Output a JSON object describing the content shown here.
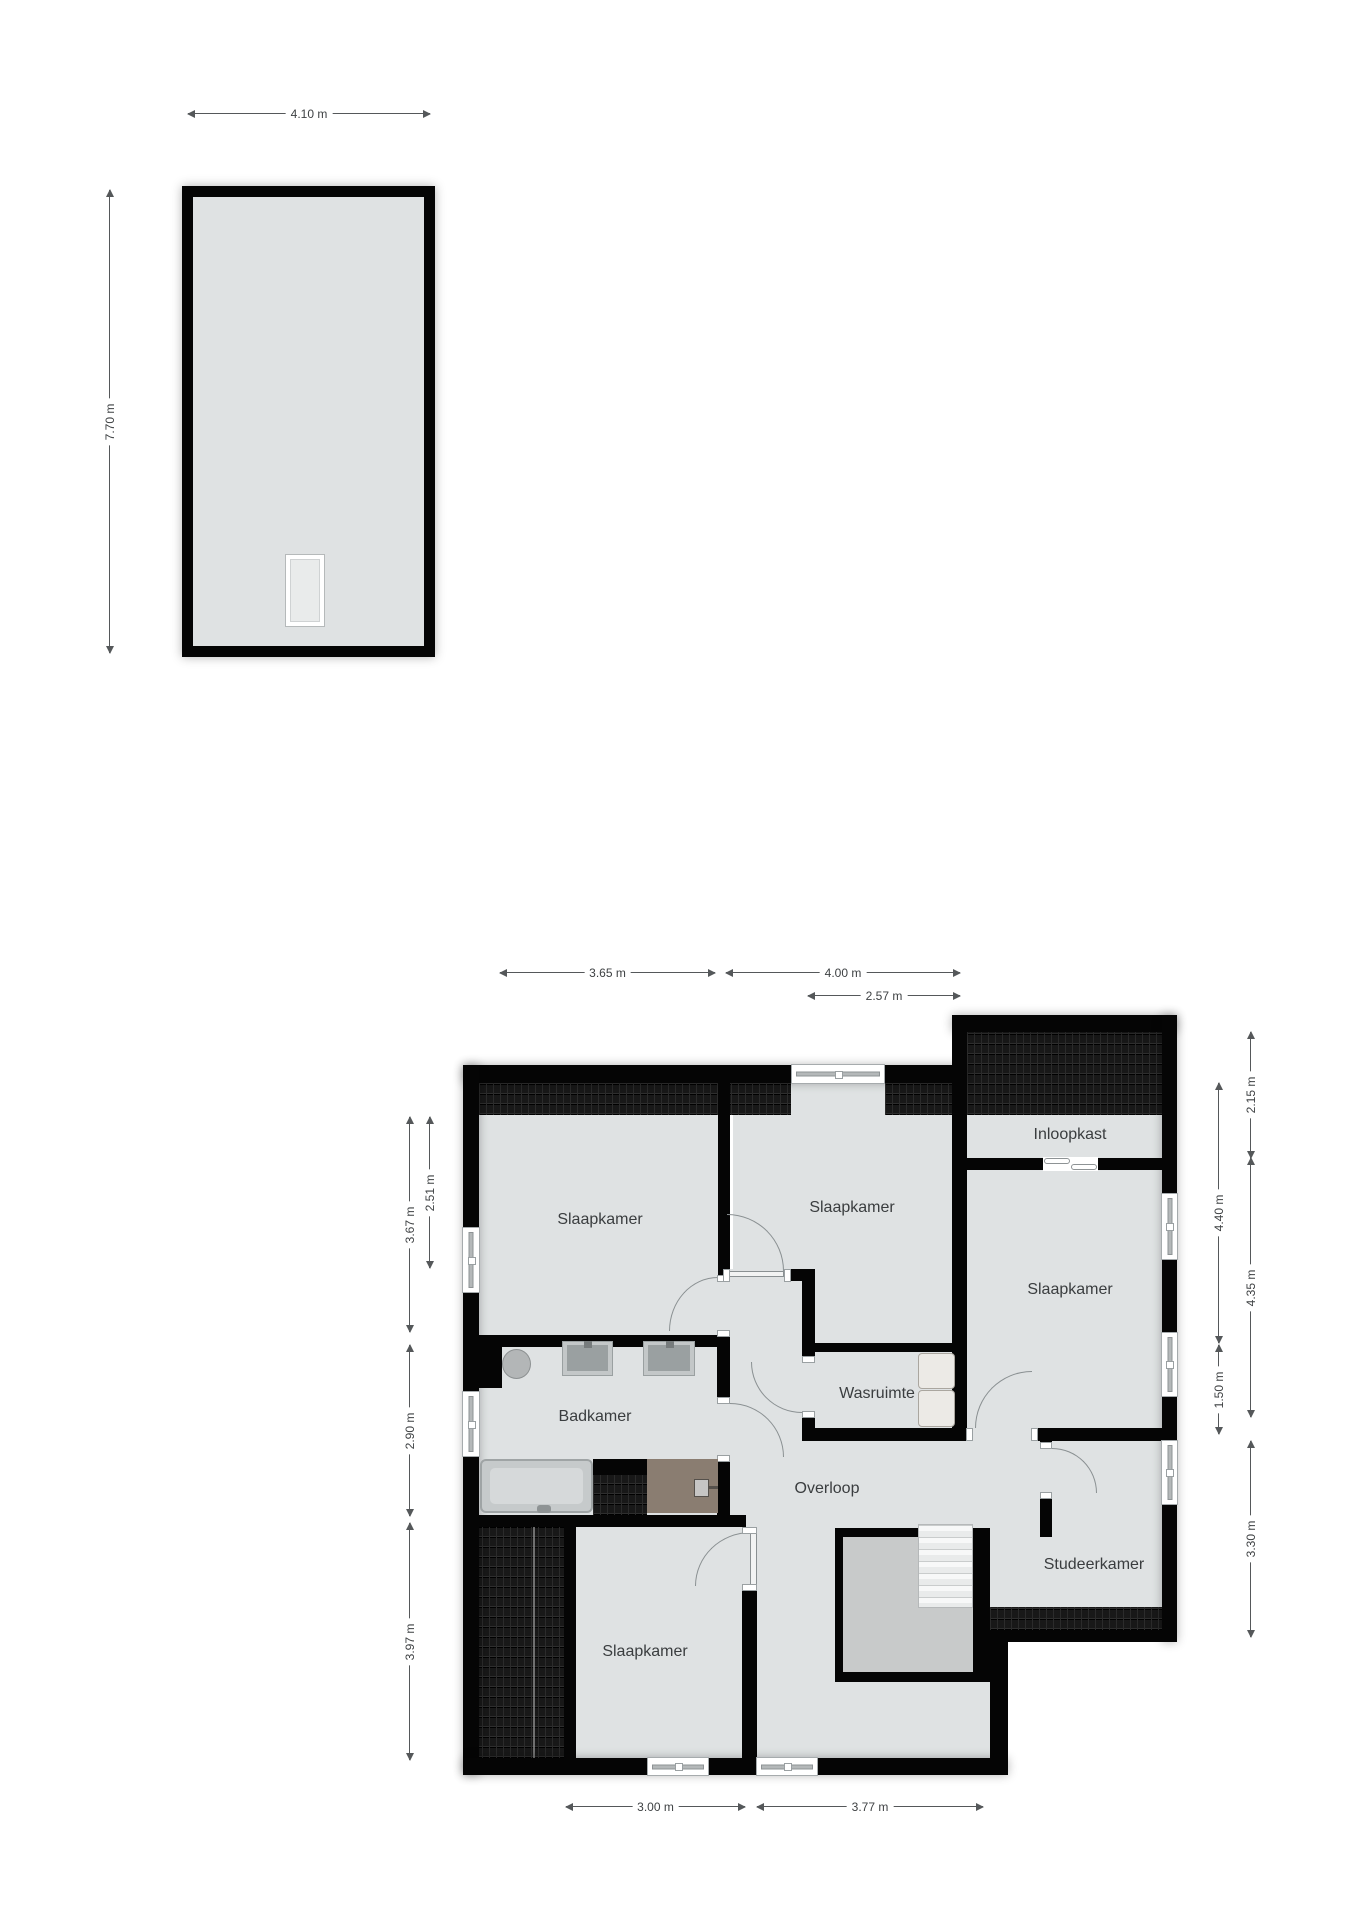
{
  "attic_plan": {
    "width_dim": "4.10 m",
    "depth_dim": "7.70 m"
  },
  "floor_plan": {
    "rooms": {
      "bedroom_nw": "Slaapkamer",
      "bedroom_n": "Slaapkamer",
      "bedroom_e": "Slaapkamer",
      "bedroom_s": "Slaapkamer",
      "bathroom": "Badkamer",
      "laundry": "Wasruimte",
      "landing": "Overloop",
      "walk_in_closet": "Inloopkast",
      "study": "Studeerkamer"
    },
    "dimensions": {
      "top_left": "3.65 m",
      "top_right": "4.00 m",
      "top_inner": "2.57 m",
      "left_outer_top": "3.67 m",
      "left_inner_top": "2.51 m",
      "left_outer_mid": "2.90 m",
      "left_outer_bottom": "3.97 m",
      "right_outer_top": "2.15 m",
      "right_inner_top": "4.40 m",
      "right_outer_mid": "4.35 m",
      "right_inner_mid": "1.50 m",
      "right_outer_bottom": "3.30 m",
      "bottom_left": "3.00 m",
      "bottom_right": "3.77 m"
    },
    "colors": {
      "wall": "#050505",
      "room_fill": "#dfe2e3",
      "stairwell_void_fill": "#c8caca",
      "roof_hatch": "#181818",
      "cabinet_fill": "#8a7d71"
    }
  }
}
